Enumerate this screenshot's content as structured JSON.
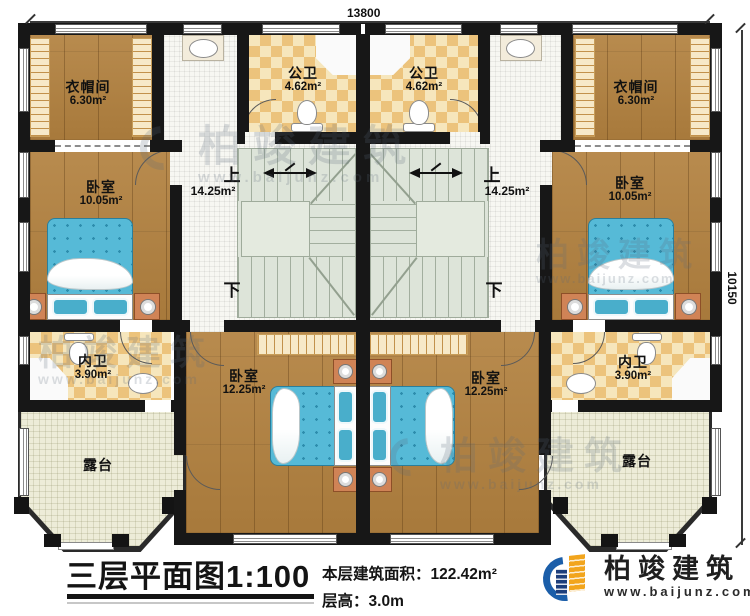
{
  "dimensions": {
    "top": "13800",
    "right": "10150"
  },
  "rooms": {
    "cloak_l": {
      "name": "衣帽间",
      "area": "6.30m²"
    },
    "cloak_r": {
      "name": "衣帽间",
      "area": "6.30m²"
    },
    "pub_l": {
      "name": "公卫",
      "area": "4.62m²"
    },
    "pub_r": {
      "name": "公卫",
      "area": "4.62m²"
    },
    "bed_l": {
      "name": "卧室",
      "area": "10.05m²"
    },
    "bed_r": {
      "name": "卧室",
      "area": "10.05m²"
    },
    "stair_l": {
      "up": "上",
      "down": "下",
      "area": "14.25m²"
    },
    "stair_r": {
      "up": "上",
      "down": "下",
      "area": "14.25m²"
    },
    "in_l": {
      "name": "内卫",
      "area": "3.90m²"
    },
    "in_r": {
      "name": "内卫",
      "area": "3.90m²"
    },
    "bed2_l": {
      "name": "卧室",
      "area": "12.25m²"
    },
    "bed2_r": {
      "name": "卧室",
      "area": "12.25m²"
    },
    "terr_l": {
      "name": "露台"
    },
    "terr_r": {
      "name": "露台"
    }
  },
  "footer": {
    "title": "三层平面图1:100",
    "area_label": "本层建筑面积：",
    "area_value": "122.42m²",
    "height_label": "层高：",
    "height_value": "3.0m"
  },
  "logo": {
    "brand": "柏竣建筑",
    "url": "www.baijunz.com"
  },
  "watermark": {
    "brand": "柏竣建筑",
    "url": "www.baijunz.com"
  },
  "colors": {
    "wall": "#171717",
    "wood_floor": "#b2813f",
    "bath_checker": "#ecc37c",
    "hall_tile": "#f7f7f2",
    "stair_green": "#dde4d9",
    "terrace": "#edecd8",
    "bed_blue": "#56bad7",
    "nightstand": "#d08356",
    "logo_blue": "#1b5ea9",
    "logo_orange": "#f2a51d"
  }
}
